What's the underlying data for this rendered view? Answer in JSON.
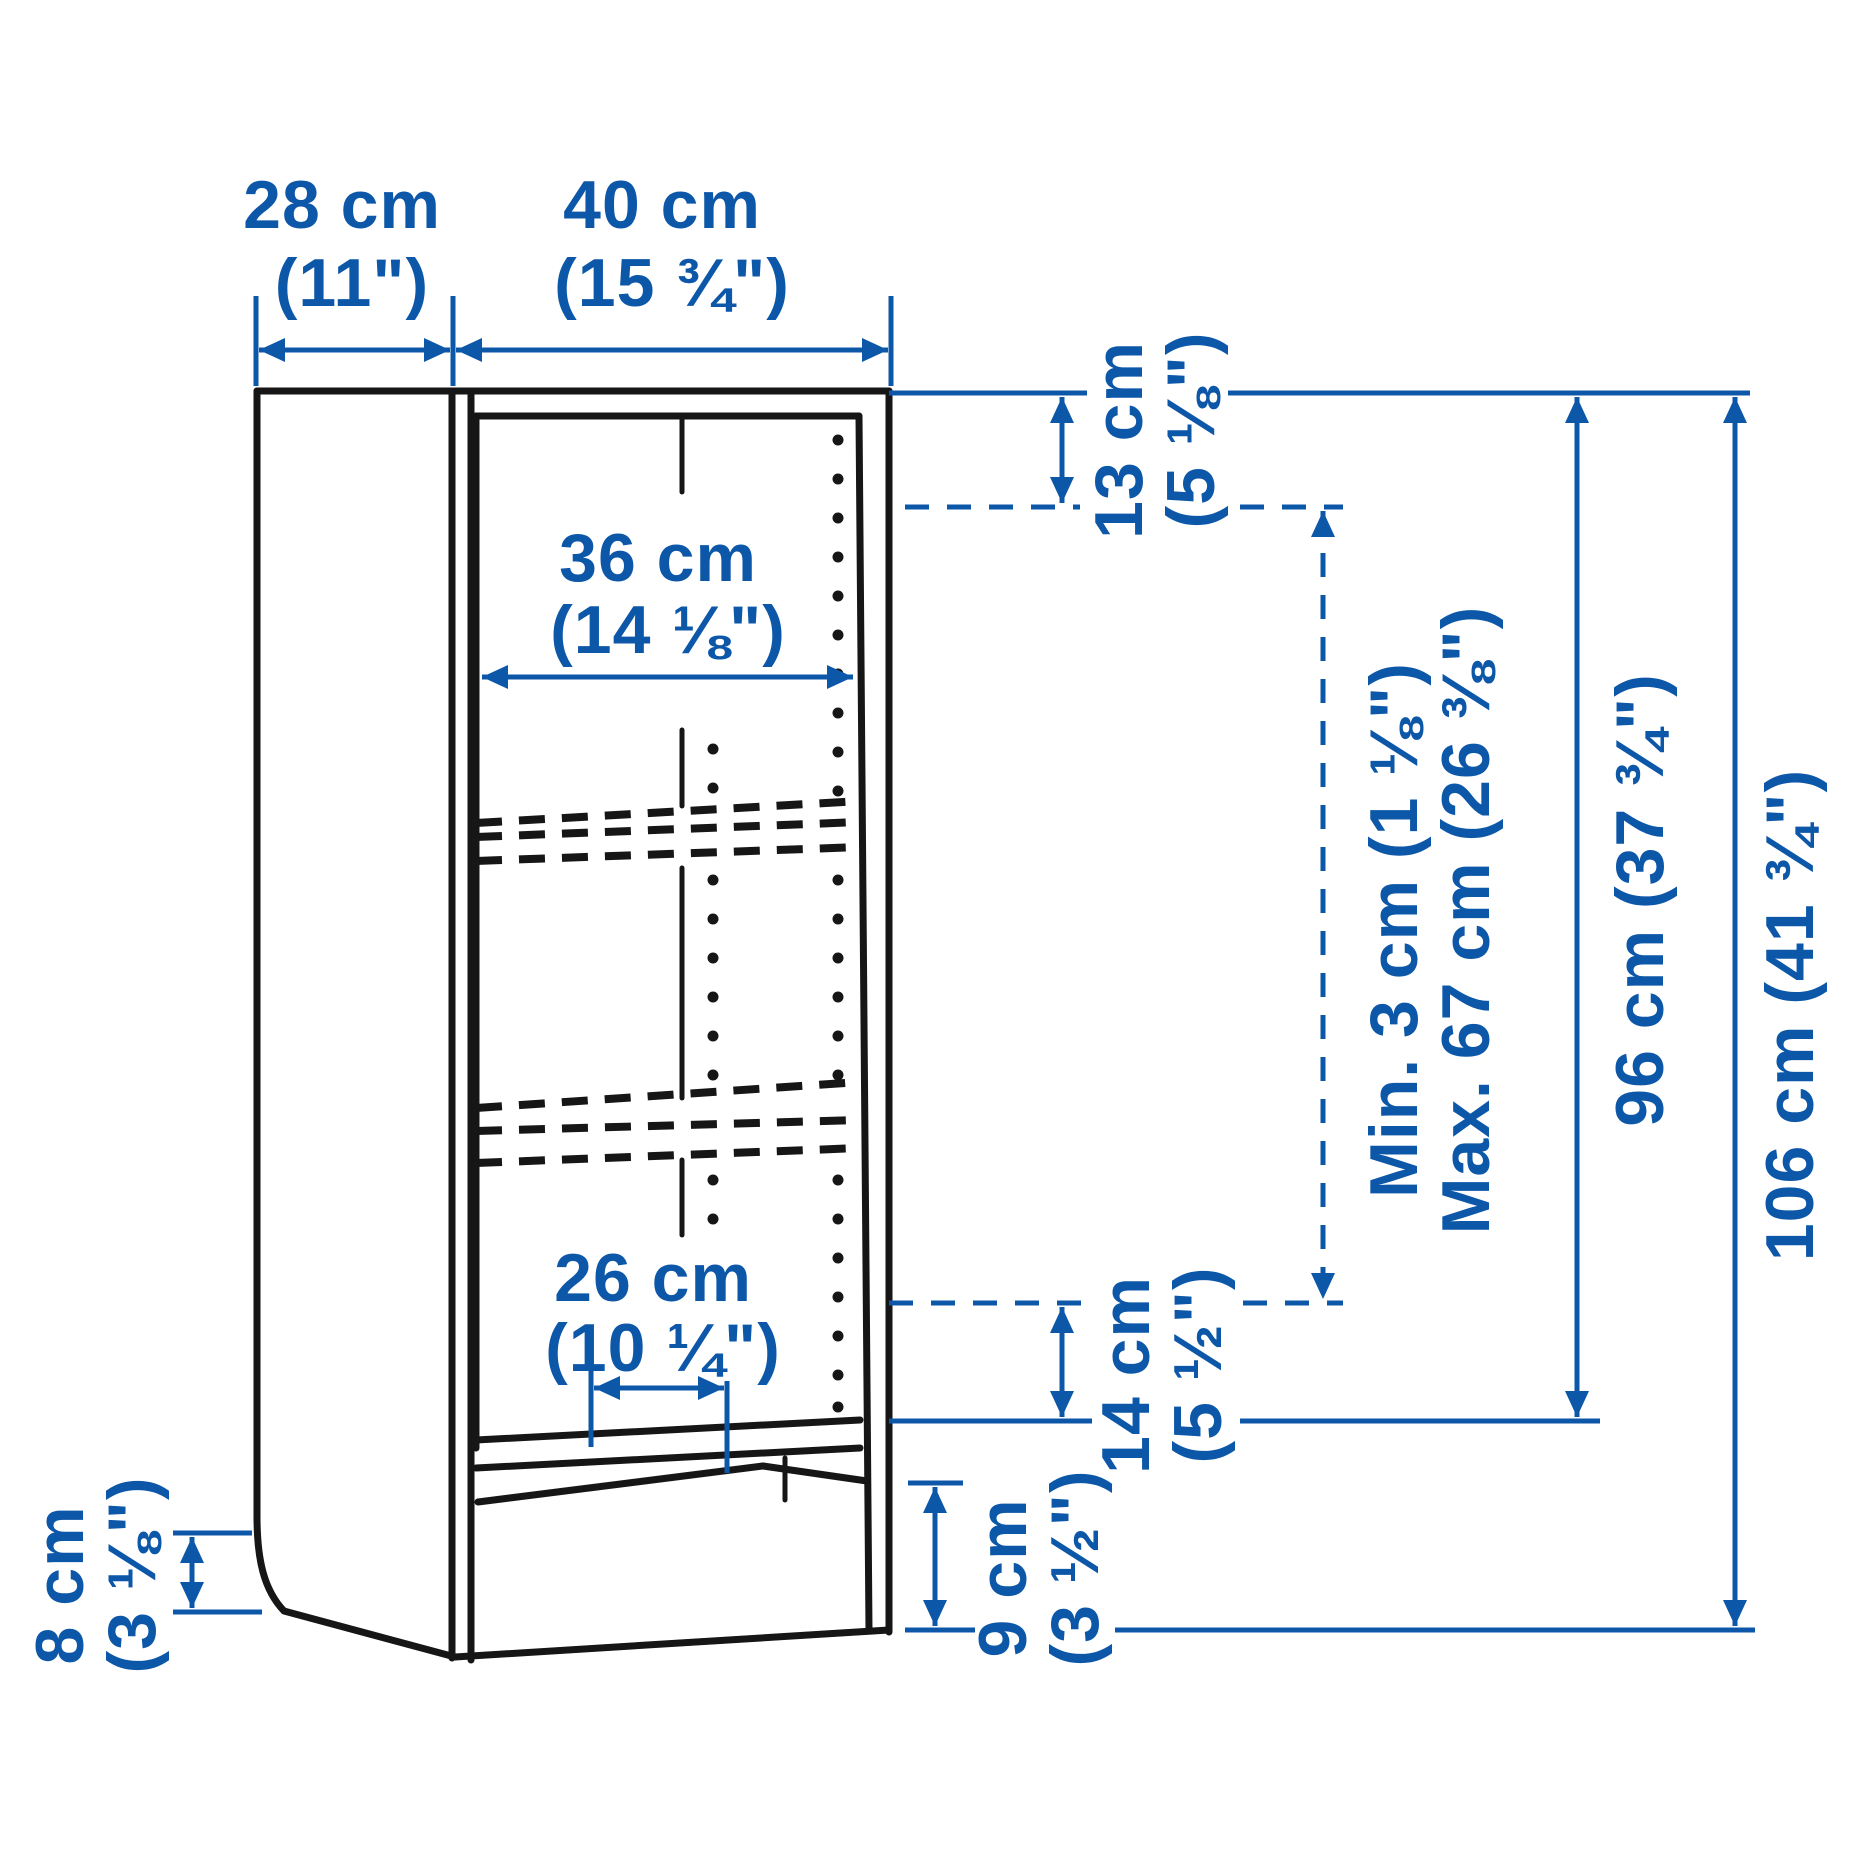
{
  "page": {
    "background": "#ffffff"
  },
  "colors": {
    "dimension_blue": "#0d57a9",
    "outline_black": "#161616"
  },
  "diagram": {
    "kind": "bookcase-dimension-diagram",
    "dimensions": {
      "depth": {
        "metric": "28 cm",
        "imperial": "(11\")"
      },
      "width": {
        "metric": "40 cm",
        "imperial": "(15 ¾\")"
      },
      "interior_width": {
        "metric": "36 cm",
        "imperial": "(14 ⅛\")"
      },
      "top_shelf_offset": {
        "metric": "13 cm",
        "imperial": "(5 ⅛\")"
      },
      "shelf_adjust_min": "Min. 3 cm (1 ⅛\")",
      "shelf_adjust_max": "Max. 67 cm (26 ⅜\")",
      "upper_section_height": "96 cm (37 ¾\")",
      "total_height": "106 cm (41 ¾\")",
      "shelf_depth": {
        "metric": "26 cm",
        "imperial": "(10 ¼\")"
      },
      "bottom_shelf_offset": {
        "metric": "14 cm",
        "imperial": "(5 ½\")"
      },
      "plinth_height": {
        "metric": "9 cm",
        "imperial": "(3 ½\")"
      },
      "base_cutout_height": {
        "metric": "8 cm",
        "imperial": "(3 ⅛\")"
      }
    }
  }
}
